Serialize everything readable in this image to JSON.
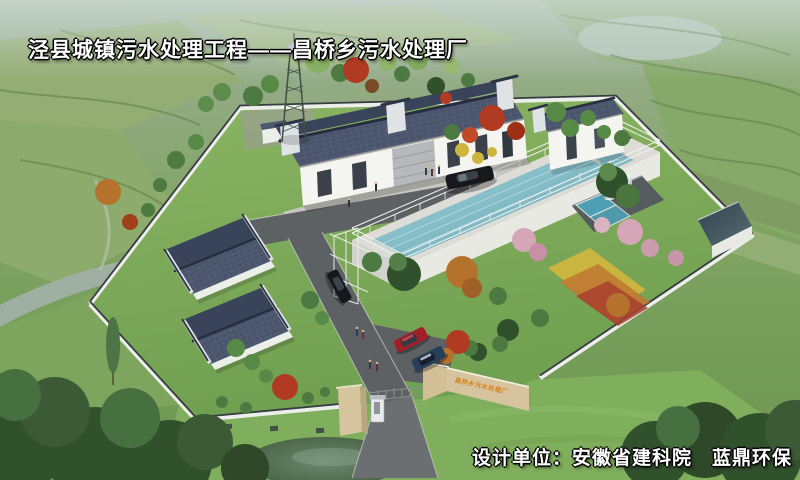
{
  "scene": {
    "title": "泾县城镇污水处理工程——昌桥乡污水处理厂",
    "credit": "设计单位：安徽省建科院　蓝鼎环保",
    "gate_sign": "昌桥乡污水处理厂"
  },
  "colors": {
    "title_color": "#ffffff",
    "haze": "#a9bcae",
    "field_light": "#9db87c",
    "field_mid": "#83a765",
    "field_deep": "#6f9a52",
    "lawn": "#7cab58",
    "road": "#5d6164",
    "road_outer": "#6b6f72",
    "pavement": "#c6c6c0",
    "wall_white": "#eceeea",
    "wall_cap": "#373c40",
    "roof_dark": "#4d5870",
    "roof_shadow": "#39435a",
    "ridge": "#262e40",
    "building_wall": "#f4f4f0",
    "tank_concrete": "#dddcd6",
    "water_teal": "#7fbcc8",
    "pool_blue": "#4f9fb4",
    "steel": "#c5ccd2",
    "tree_green": "#4d7a40",
    "tree_dark": "#31502c",
    "bamboo_green": "#578a46",
    "maple_red": "#b13a22",
    "maple_orange": "#b5722c",
    "blossom_pink": "#d5a6b8",
    "shrub_yellow": "#cdb53e",
    "flower_yellow": "#cdb53e",
    "flower_orange": "#c07a32",
    "flower_red": "#a8402e",
    "sign_beige": "#d6c49e",
    "sign_text_orange": "#d4821e",
    "car_black": "#16181c",
    "car_red": "#a01f28",
    "car_blue": "#273f58",
    "pond": "#54704f"
  }
}
